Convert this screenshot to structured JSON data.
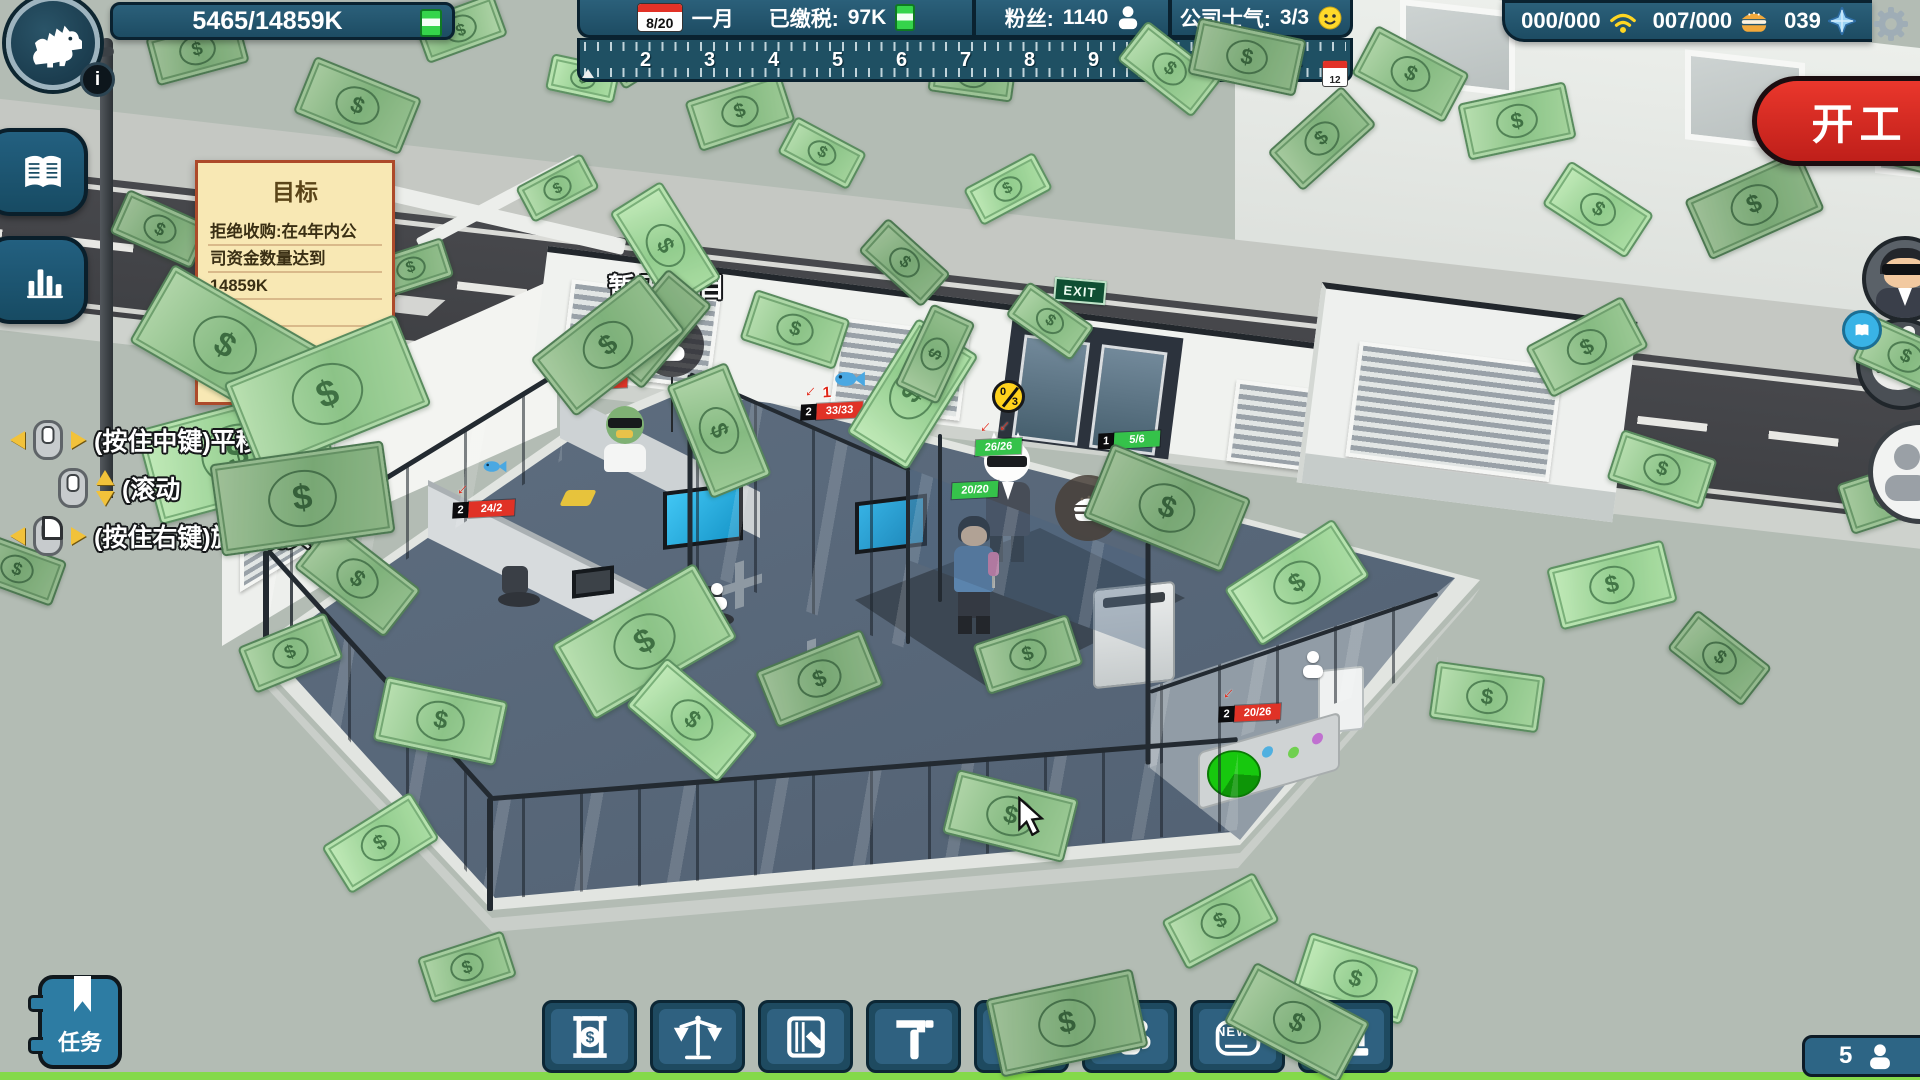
{
  "hud": {
    "funds": "5465/14859K",
    "info_label": "i",
    "calendar_day": "8/20",
    "month": "一月",
    "tax_label": "已缴税:",
    "tax_value": "97K",
    "fans_label": "粉丝:",
    "fans_value": "1140",
    "morale_label": "公司士气:",
    "morale_value": "3/3",
    "wifi_value": "000/000",
    "food_value": "007/000",
    "gem_value": "039",
    "start_button_label": "开工",
    "ruler_ticks": [
      "2",
      "3",
      "4",
      "5",
      "6",
      "7",
      "8",
      "9",
      "10",
      "11",
      "12"
    ],
    "ruler_calendar_day": "12",
    "tasks_label": "任务",
    "staff_count": "5"
  },
  "goal_note": {
    "title": "目标",
    "lines": [
      "拒绝收购:在4年内公",
      "司资金数量达到",
      "14859K"
    ]
  },
  "controls_help": {
    "pan": "(按住中键)平移镜头",
    "zoom": "(滚动",
    "rotate": "(按住右键)旋转镜头"
  },
  "toolbar": {
    "news_text": "NEWS",
    "buttons": [
      "finance",
      "legal",
      "planning",
      "build",
      "marketing",
      "staff",
      "news",
      "bank"
    ]
  },
  "scene": {
    "no_project_label": "暂无项目",
    "exit_sign": "EXIT",
    "energy_badge": {
      "current": "0",
      "max": "3"
    },
    "hp_bars": [
      {
        "level": "2",
        "hp": "20/28",
        "color": "red",
        "arrows": 1,
        "count": "1"
      },
      {
        "level": "2",
        "hp": "24/2",
        "color": "red",
        "arrows": 1,
        "count": ""
      },
      {
        "level": "2",
        "hp": "33/33",
        "color": "red",
        "arrows": 1,
        "count": "1"
      },
      {
        "level": "",
        "hp": "26/26",
        "color": "green",
        "arrows": 2,
        "count": ""
      },
      {
        "level": "",
        "hp": "20/20",
        "color": "green",
        "arrows": 0,
        "count": ""
      },
      {
        "level": "1",
        "hp": "5/6",
        "color": "green",
        "arrows": 0,
        "count": ""
      },
      {
        "level": "2",
        "hp": "20/26",
        "color": "red",
        "arrows": 1,
        "count": ""
      }
    ]
  }
}
